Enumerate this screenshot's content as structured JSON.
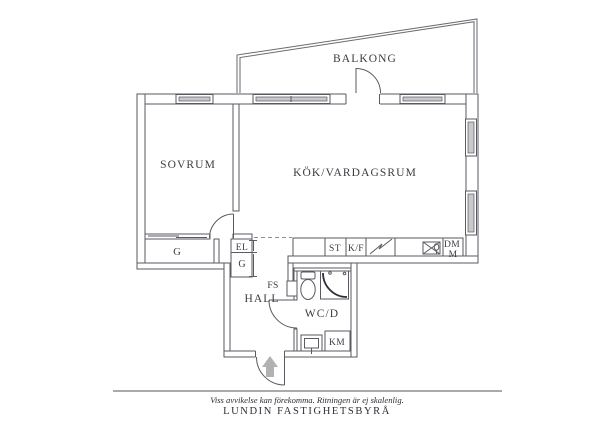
{
  "plan": {
    "balcony_label": "BALKONG",
    "bedroom_label": "SOVRUM",
    "kitchen_living_label": "KÖK/VARDAGSRUM",
    "hall_label": "HALL",
    "bathroom_label": "WC/D",
    "wardrobe_large_label": "G",
    "electrical_cabinet_label": "EL",
    "wardrobe_small_label": "G",
    "vent_shaft_label": "FS",
    "cleaning_closet_label": "ST",
    "fridge_freezer_label": "K/F",
    "dishwasher_label": "DM",
    "micro_label": "M",
    "washing_machine_label": "KM"
  },
  "footer": {
    "disclaimer": "Viss avvikelse kan förekomma. Ritningen är ej skalenlig.",
    "company": "LUNDIN FASTIGHETSBYRÅ"
  },
  "colors": {
    "line": "#5a5a60",
    "text": "#3b3b42",
    "window_glazing": "#c9c9cd",
    "entrance_arrow": "#b1b1b1",
    "background": "#ffffff"
  }
}
